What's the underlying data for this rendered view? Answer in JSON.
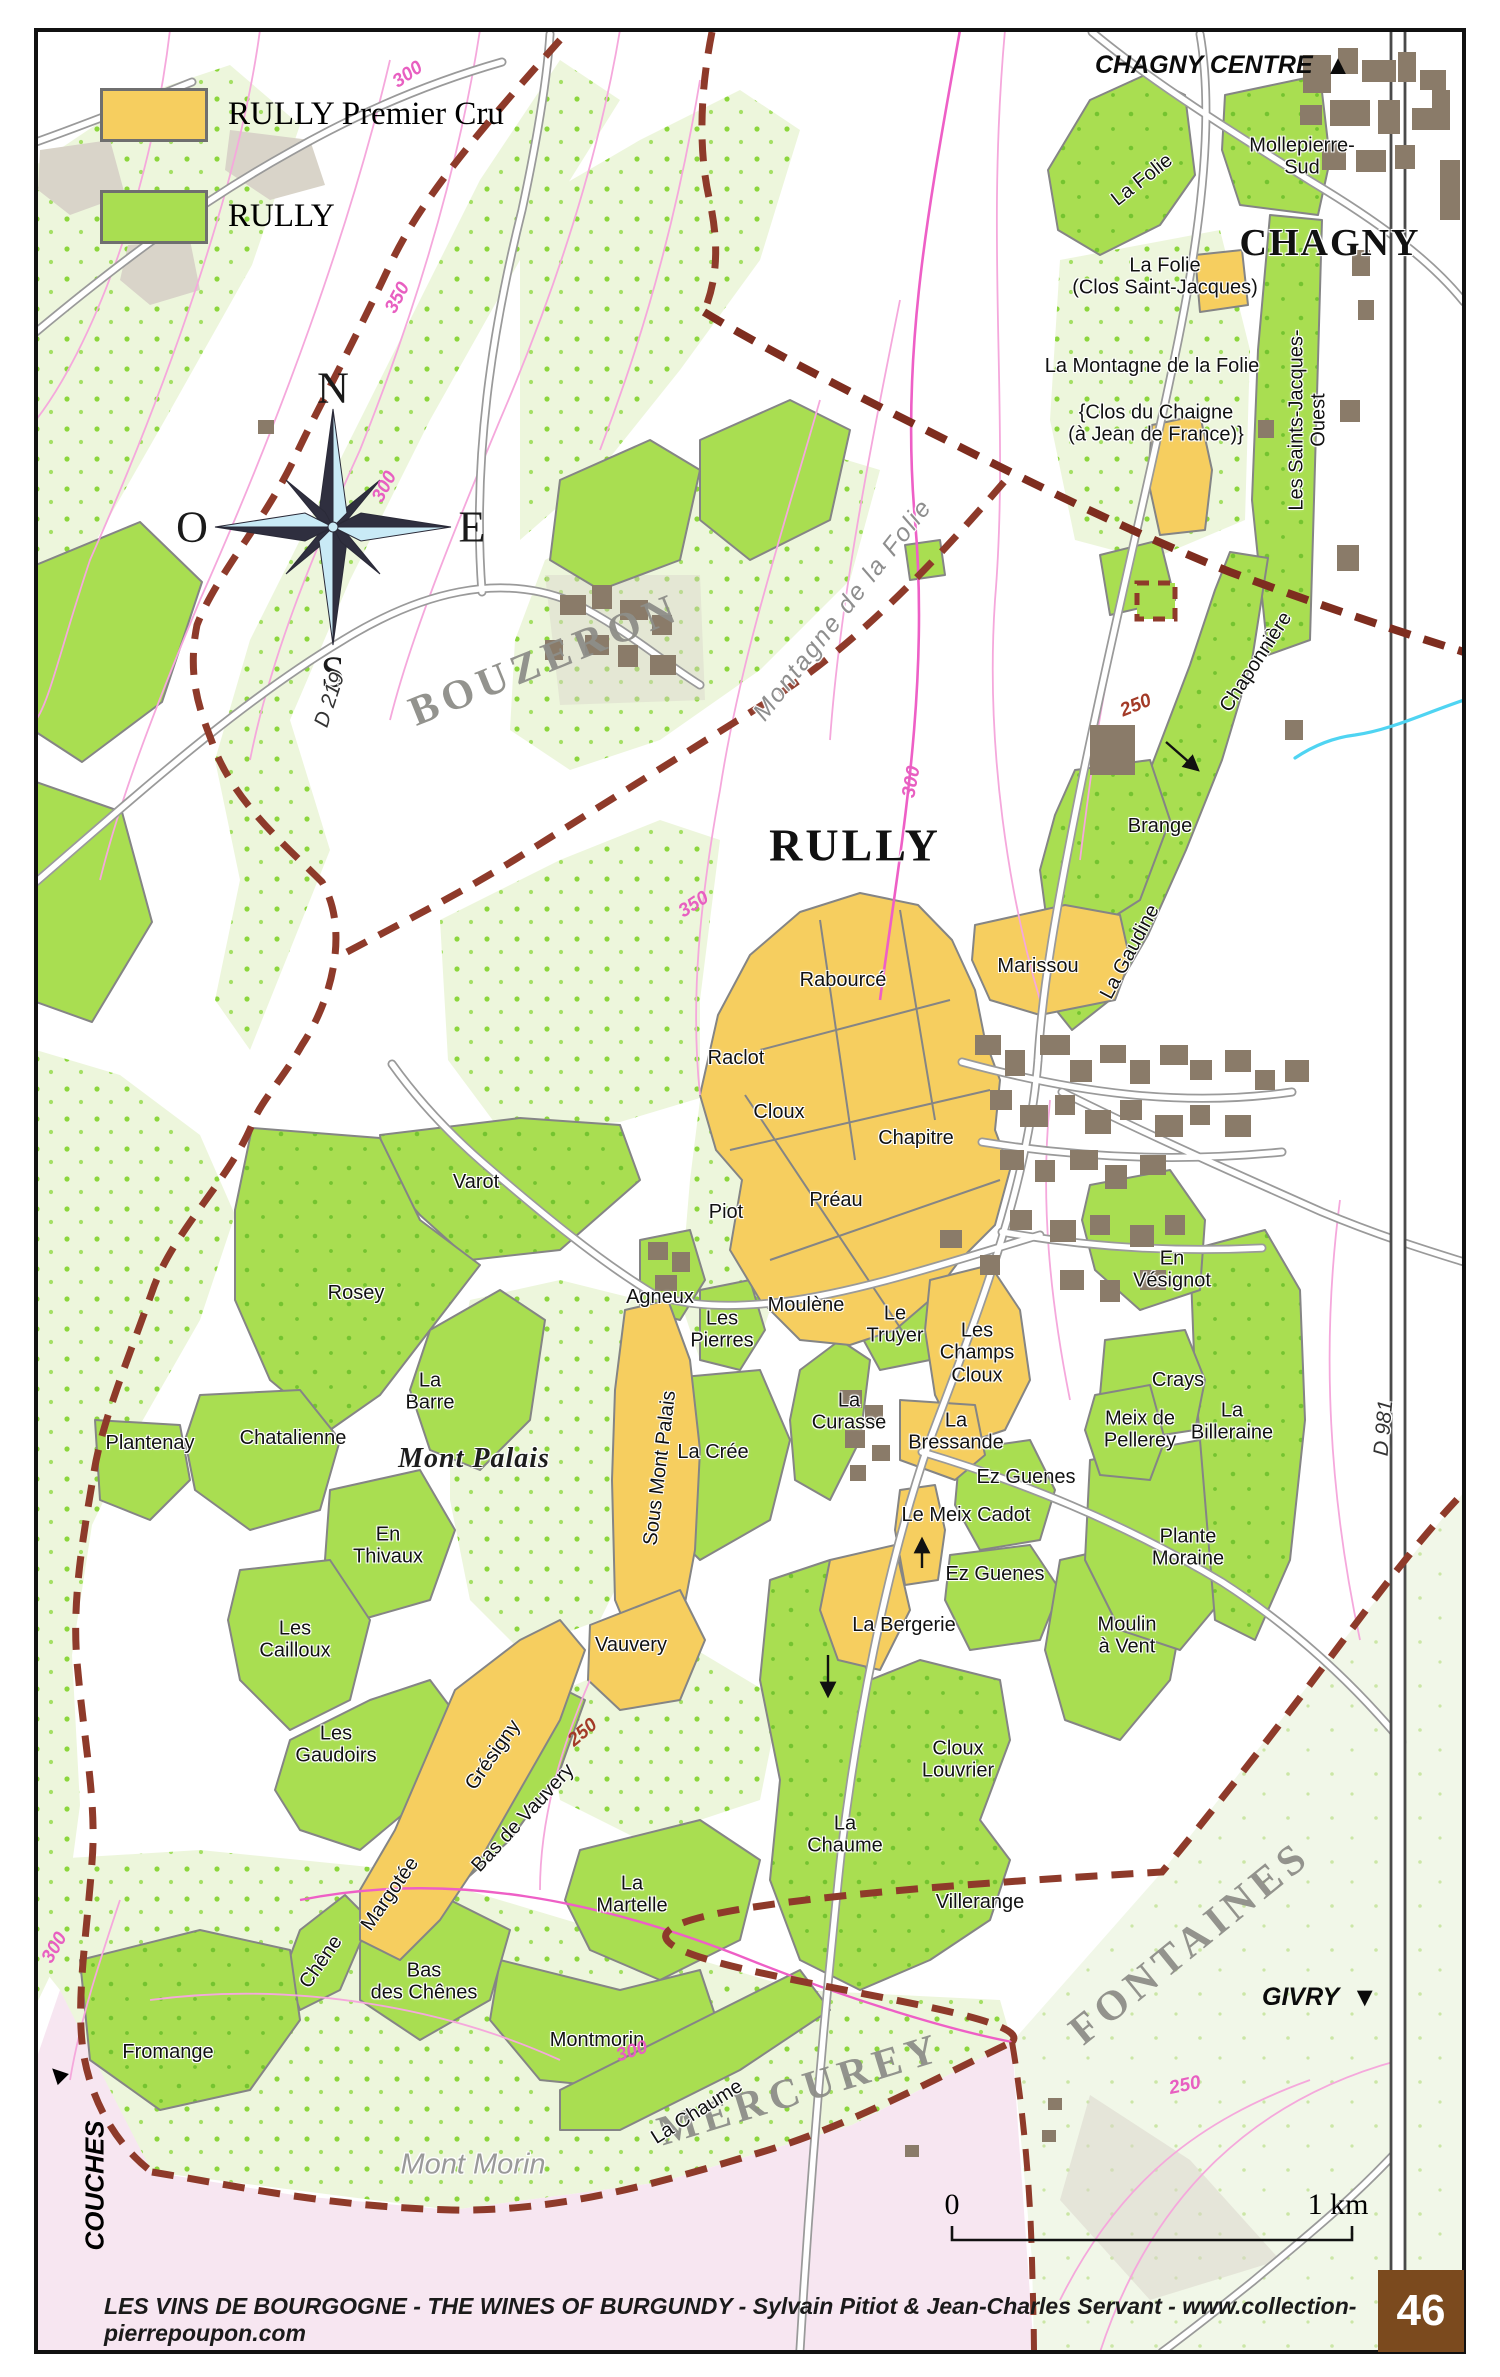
{
  "legend": {
    "premier_cru_label": "RULLY Premier Cru",
    "village_label": "RULLY"
  },
  "compass": {
    "n": "N",
    "e": "E",
    "s": "S",
    "w": "O"
  },
  "edge_labels": {
    "chagny": {
      "text": "CHAGNY CENTRE",
      "arrow": "▲"
    },
    "givry": {
      "text": "GIVRY",
      "arrow": "▼"
    },
    "couches": {
      "text": "COUCHES",
      "arrow": "▲"
    }
  },
  "scale_bar": {
    "zero": "0",
    "one_km": "1 km"
  },
  "footer": {
    "credit": "LES VINS DE BOURGOGNE - THE WINES OF BURGUNDY - Sylvain Pitiot & Jean-Charles Servant - www.collection-pierrepoupon.com",
    "page": "46"
  },
  "colors": {
    "premier_cru": "#F6CE5F",
    "village_green": "#A9DE51",
    "pale_vineyard": "#EDF6DC",
    "mercurey_pink": "#F7E6F1",
    "boundary_red": "#8E3A2A",
    "building_brown": "#8A7B69",
    "contour_pink": "#F5A8DC",
    "road_gray": "#9A9A9A",
    "page_box_brown": "#7B4A1E",
    "water_blue": "#4FD4F2"
  },
  "map_labels": [
    {
      "text": "Mollepierre-\nSud",
      "x": 1302,
      "y": 157
    },
    {
      "text": "La Folie",
      "x": 1142,
      "y": 180,
      "rot": -38
    },
    {
      "text": "CHAGNY",
      "x": 1330,
      "y": 243,
      "cls": "city"
    },
    {
      "text": "La Folie\n(Clos Saint-Jacques)",
      "x": 1165,
      "y": 277
    },
    {
      "text": "La Montagne de la Folie",
      "x": 1152,
      "y": 366
    },
    {
      "text": "{Clos du Chaigne\n(à Jean de France)}",
      "x": 1156,
      "y": 424
    },
    {
      "text": "Les Saints-Jacques-Ouest",
      "x": 1308,
      "y": 420,
      "rot": -90
    },
    {
      "text": "Chaponnière",
      "x": 1256,
      "y": 662,
      "rot": -57
    },
    {
      "text": "250",
      "x": 1136,
      "y": 706,
      "rot": -22,
      "cls": "contour-red"
    },
    {
      "text": "Brange",
      "x": 1160,
      "y": 826
    },
    {
      "text": "La Gaudine",
      "x": 1130,
      "y": 952,
      "rot": -62
    },
    {
      "text": "Marissou",
      "x": 1038,
      "y": 966
    },
    {
      "text": "RULLY",
      "x": 855,
      "y": 845,
      "cls": "title"
    },
    {
      "text": "BOUZERON",
      "x": 545,
      "y": 660,
      "rot": -22,
      "cls": "region"
    },
    {
      "text": "Montagne de la Folie",
      "x": 843,
      "y": 610,
      "rot": -52,
      "cls": "gray-it"
    },
    {
      "text": "MERCUREY",
      "x": 800,
      "y": 2090,
      "rot": -17,
      "cls": "region"
    },
    {
      "text": "FONTAINES",
      "x": 1190,
      "y": 1943,
      "rot": -39,
      "cls": "region"
    },
    {
      "text": "Mont Morin",
      "x": 473,
      "y": 2165,
      "cls": "gray-it2"
    },
    {
      "text": "Mont Palais",
      "x": 474,
      "y": 1459,
      "cls": "mont"
    },
    {
      "text": "Rabourcé",
      "x": 843,
      "y": 980
    },
    {
      "text": "Raclot",
      "x": 736,
      "y": 1058
    },
    {
      "text": "Cloux",
      "x": 779,
      "y": 1112
    },
    {
      "text": "Chapitre",
      "x": 916,
      "y": 1138
    },
    {
      "text": "Préau",
      "x": 836,
      "y": 1200
    },
    {
      "text": "Piot",
      "x": 726,
      "y": 1212
    },
    {
      "text": "Moulène",
      "x": 806,
      "y": 1305
    },
    {
      "text": "Agneux",
      "x": 660,
      "y": 1297
    },
    {
      "text": "Les\nPierres",
      "x": 722,
      "y": 1330
    },
    {
      "text": "Le\nTruyer",
      "x": 895,
      "y": 1325
    },
    {
      "text": "Les\nChamps\nCloux",
      "x": 977,
      "y": 1353
    },
    {
      "text": "La\nCurasse",
      "x": 849,
      "y": 1412
    },
    {
      "text": "La\nBressande",
      "x": 956,
      "y": 1432
    },
    {
      "text": "Ez Guenes",
      "x": 1026,
      "y": 1477
    },
    {
      "text": "Le Meix Cadot",
      "x": 966,
      "y": 1515
    },
    {
      "text": "Ez Guenes",
      "x": 995,
      "y": 1574
    },
    {
      "text": "La Bergerie",
      "x": 904,
      "y": 1625
    },
    {
      "text": "Cloux\nLouvrier",
      "x": 958,
      "y": 1760
    },
    {
      "text": "La\nChaume",
      "x": 845,
      "y": 1835
    },
    {
      "text": "Villerange",
      "x": 980,
      "y": 1902
    },
    {
      "text": "Moulin\nà Vent",
      "x": 1127,
      "y": 1636
    },
    {
      "text": "Plante\nMoraine",
      "x": 1188,
      "y": 1548
    },
    {
      "text": "En\nVésignot",
      "x": 1172,
      "y": 1270
    },
    {
      "text": "Crays",
      "x": 1178,
      "y": 1380
    },
    {
      "text": "Meix de\nPellerey",
      "x": 1140,
      "y": 1430
    },
    {
      "text": "La\nBilleraine",
      "x": 1232,
      "y": 1422
    },
    {
      "text": "En\nVaroté",
      "x": -500,
      "y": -500
    },
    {
      "text": "Varot",
      "x": 476,
      "y": 1182
    },
    {
      "text": "Rosey",
      "x": 356,
      "y": 1293
    },
    {
      "text": "La\nBarre",
      "x": 430,
      "y": 1392
    },
    {
      "text": "Chatalienne",
      "x": 293,
      "y": 1438
    },
    {
      "text": "Plantenay",
      "x": 150,
      "y": 1443
    },
    {
      "text": "En\nThivaux",
      "x": 388,
      "y": 1546
    },
    {
      "text": "Les\nCailloux",
      "x": 295,
      "y": 1640
    },
    {
      "text": "Les\nGaudoirs",
      "x": 336,
      "y": 1745
    },
    {
      "text": "Sous Mont Palais",
      "x": 660,
      "y": 1468,
      "rot": -83
    },
    {
      "text": "La Crée",
      "x": 713,
      "y": 1452
    },
    {
      "text": "Vauvery",
      "x": 631,
      "y": 1645
    },
    {
      "text": "Grésigny",
      "x": 493,
      "y": 1755,
      "rot": -55
    },
    {
      "text": "Bas de Vauvery",
      "x": 523,
      "y": 1818,
      "rot": -47
    },
    {
      "text": "250",
      "x": 583,
      "y": 1733,
      "rot": -40,
      "cls": "contour-red"
    },
    {
      "text": "Margotée",
      "x": 390,
      "y": 1894,
      "rot": -55
    },
    {
      "text": "Chêne",
      "x": 321,
      "y": 1962,
      "rot": -55
    },
    {
      "text": "Bas\ndes Chênes",
      "x": 424,
      "y": 1982
    },
    {
      "text": "La\nMartelle",
      "x": 632,
      "y": 1895
    },
    {
      "text": "Montmorin",
      "x": 597,
      "y": 2040
    },
    {
      "text": "Fromange",
      "x": 168,
      "y": 2052
    },
    {
      "text": "La Chaume",
      "x": 697,
      "y": 2112,
      "rot": -32
    },
    {
      "text": "D 219",
      "x": 330,
      "y": 700,
      "rot": -72,
      "cls": "road"
    },
    {
      "text": "D 981",
      "x": 1384,
      "y": 1428,
      "rot": -85,
      "cls": "road"
    },
    {
      "text": "300",
      "x": 408,
      "y": 75,
      "rot": -35,
      "cls": "contour"
    },
    {
      "text": "350",
      "x": 398,
      "y": 298,
      "rot": -62,
      "cls": "contour"
    },
    {
      "text": "300",
      "x": 385,
      "y": 487,
      "rot": -62,
      "cls": "contour"
    },
    {
      "text": "350",
      "x": 694,
      "y": 905,
      "rot": -33,
      "cls": "contour"
    },
    {
      "text": "300",
      "x": 912,
      "y": 782,
      "rot": -80,
      "cls": "contour"
    },
    {
      "text": "300",
      "x": 632,
      "y": 2052,
      "rot": -18,
      "cls": "contour"
    },
    {
      "text": "250",
      "x": 1185,
      "y": 2086,
      "rot": -12,
      "cls": "contour"
    },
    {
      "text": "300",
      "x": 55,
      "y": 1948,
      "rot": -60,
      "cls": "contour"
    }
  ]
}
